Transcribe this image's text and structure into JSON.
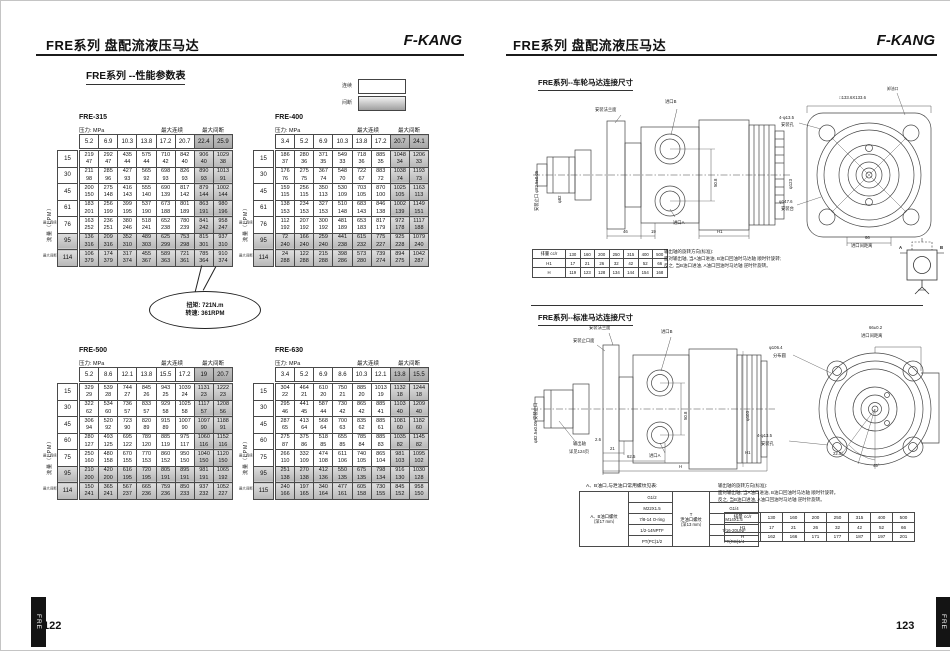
{
  "header": {
    "title": "FRE系列 盘配流液压马达",
    "brand": "F-KANG",
    "page_left": "122",
    "page_right": "123",
    "tab": "FRE"
  },
  "performance": {
    "section_title": "FRE系列 --性能参数表",
    "pressure_label": "压力: MPa",
    "flow_label": "流量（LPM）",
    "max_cont": "最大连续",
    "max_int": "最大间断",
    "legend": {
      "continuous": "连续",
      "intermittent": "间断"
    },
    "callout": {
      "line1": "扭矩: 721N.m",
      "line2": "转速: 361RPM"
    },
    "tables": [
      {
        "name": "FRE-315",
        "pressures": [
          "5.2",
          "6.9",
          "10.3",
          "13.8",
          "17.2",
          "20.7",
          "22.4",
          "25.9"
        ],
        "rows": [
          {
            "flow": "15",
            "torque": [
              219,
              292,
              435,
              575,
              710,
              842,
              906,
              1029
            ],
            "speed": [
              47,
              47,
              44,
              44,
              42,
              40,
              40,
              38
            ]
          },
          {
            "flow": "30",
            "torque": [
              211,
              285,
              427,
              565,
              698,
              826,
              890,
              1013
            ],
            "speed": [
              98,
              96,
              93,
              92,
              93,
              93,
              93,
              91
            ]
          },
          {
            "flow": "45",
            "torque": [
              200,
              275,
              416,
              555,
              690,
              817,
              879,
              1002
            ],
            "speed": [
              150,
              148,
              143,
              140,
              139,
              142,
              144,
              144
            ]
          },
          {
            "flow": "61",
            "torque": [
              183,
              256,
              399,
              537,
              673,
              801,
              863,
              980
            ],
            "speed": [
              201,
              199,
              195,
              190,
              188,
              189,
              191,
              196
            ]
          },
          {
            "flow": "76",
            "torque": [
              163,
              236,
              380,
              518,
              652,
              780,
              841,
              958
            ],
            "speed": [
              252,
              251,
              246,
              241,
              238,
              239,
              242,
              247
            ]
          },
          {
            "flow": "95",
            "torque": [
              136,
              209,
              352,
              489,
              625,
              753,
              815,
              937
            ],
            "speed": [
              316,
              316,
              310,
              303,
              299,
              298,
              301,
              310
            ]
          },
          {
            "flow": "114",
            "torque": [
              106,
              174,
              317,
              455,
              589,
              721,
              785,
              910
            ],
            "speed": [
              379,
              379,
              374,
              367,
              363,
              361,
              364,
              374
            ]
          }
        ]
      },
      {
        "name": "FRE-400",
        "pressures": [
          "3.4",
          "5.2",
          "6.9",
          "10.3",
          "13.8",
          "17.2",
          "20.7",
          "24.1"
        ],
        "rows": [
          {
            "flow": "15",
            "torque": [
              186,
              280,
              371,
              549,
              718,
              885,
              1048,
              1206
            ],
            "speed": [
              37,
              36,
              35,
              33,
              36,
              35,
              34,
              33
            ]
          },
          {
            "flow": "30",
            "torque": [
              176,
              275,
              367,
              548,
              722,
              883,
              1038,
              1193
            ],
            "speed": [
              76,
              75,
              74,
              70,
              67,
              72,
              74,
              73
            ]
          },
          {
            "flow": "45",
            "torque": [
              159,
              256,
              350,
              530,
              703,
              870,
              1025,
              1163
            ],
            "speed": [
              115,
              115,
              113,
              109,
              105,
              100,
              105,
              113
            ]
          },
          {
            "flow": "61",
            "torque": [
              138,
              234,
              327,
              510,
              683,
              846,
              1002,
              1149
            ],
            "speed": [
              153,
              153,
              153,
              148,
              143,
              138,
              139,
              151
            ]
          },
          {
            "flow": "76",
            "torque": [
              112,
              207,
              300,
              481,
              653,
              817,
              972,
              1117
            ],
            "speed": [
              192,
              192,
              192,
              189,
              183,
              179,
              178,
              188
            ]
          },
          {
            "flow": "95",
            "torque": [
              72,
              166,
              259,
              441,
              615,
              775,
              925,
              1079
            ],
            "speed": [
              240,
              240,
              240,
              238,
              232,
              227,
              228,
              240
            ]
          },
          {
            "flow": "114",
            "torque": [
              24,
              122,
              215,
              398,
              573,
              739,
              894,
              1042
            ],
            "speed": [
              288,
              288,
              288,
              286,
              280,
              274,
              275,
              287
            ]
          }
        ]
      },
      {
        "name": "FRE-500",
        "pressures": [
          "5.2",
          "8.6",
          "12.1",
          "13.8",
          "15.5",
          "17.2",
          "19",
          "20.7"
        ],
        "rows": [
          {
            "flow": "15",
            "torque": [
              329,
              539,
              744,
              845,
              943,
              1039,
              1131,
              1222
            ],
            "speed": [
              29,
              28,
              27,
              26,
              25,
              24,
              23,
              23
            ]
          },
          {
            "flow": "30",
            "torque": [
              322,
              534,
              736,
              833,
              929,
              1025,
              1117,
              1208
            ],
            "speed": [
              62,
              60,
              57,
              57,
              58,
              58,
              57,
              56
            ]
          },
          {
            "flow": "45",
            "torque": [
              306,
              520,
              723,
              820,
              915,
              1007,
              1097,
              1188
            ],
            "speed": [
              94,
              92,
              90,
              89,
              89,
              90,
              90,
              91
            ]
          },
          {
            "flow": "60",
            "torque": [
              280,
              493,
              695,
              789,
              885,
              975,
              1060,
              1152
            ],
            "speed": [
              127,
              125,
              122,
              120,
              119,
              117,
              116,
              116
            ]
          },
          {
            "flow": "75",
            "torque": [
              250,
              480,
              670,
              770,
              860,
              950,
              1040,
              1120
            ],
            "speed": [
              160,
              158,
              155,
              153,
              152,
              150,
              150,
              150
            ]
          },
          {
            "flow": "95",
            "torque": [
              210,
              420,
              616,
              720,
              805,
              895,
              981,
              1065
            ],
            "speed": [
              200,
              200,
              195,
              195,
              191,
              191,
              191,
              192
            ]
          },
          {
            "flow": "114",
            "torque": [
              150,
              365,
              567,
              665,
              759,
              850,
              937,
              1052
            ],
            "speed": [
              241,
              241,
              237,
              236,
              236,
              233,
              232,
              227
            ]
          }
        ]
      },
      {
        "name": "FRE-630",
        "pressures": [
          "3.4",
          "5.2",
          "6.9",
          "8.6",
          "10.3",
          "12.1",
          "13.8",
          "15.5"
        ],
        "rows": [
          {
            "flow": "15",
            "torque": [
              304,
              464,
              610,
              750,
              885,
              1013,
              1132,
              1244
            ],
            "speed": [
              22,
              21,
              20,
              21,
              20,
              19,
              18,
              18
            ]
          },
          {
            "flow": "30",
            "torque": [
              295,
              441,
              587,
              730,
              865,
              885,
              1103,
              1209
            ],
            "speed": [
              46,
              45,
              44,
              42,
              42,
              41,
              40,
              40
            ]
          },
          {
            "flow": "45",
            "torque": [
              287,
              413,
              568,
              700,
              835,
              885,
              1081,
              1182
            ],
            "speed": [
              65,
              64,
              64,
              63,
              62,
              61,
              60,
              60
            ]
          },
          {
            "flow": "60",
            "torque": [
              275,
              375,
              518,
              655,
              785,
              885,
              1035,
              1145
            ],
            "speed": [
              87,
              86,
              85,
              85,
              84,
              83,
              82,
              82
            ]
          },
          {
            "flow": "75",
            "torque": [
              266,
              332,
              474,
              611,
              740,
              865,
              981,
              1095
            ],
            "speed": [
              110,
              109,
              108,
              106,
              105,
              104,
              103,
              102
            ]
          },
          {
            "flow": "95",
            "torque": [
              251,
              270,
              412,
              550,
              675,
              798,
              916,
              1030
            ],
            "speed": [
              138,
              138,
              136,
              135,
              135,
              134,
              130,
              128
            ]
          },
          {
            "flow": "115",
            "torque": [
              240,
              197,
              340,
              477,
              605,
              730,
              845,
              958
            ],
            "speed": [
              166,
              165,
              164,
              161,
              158,
              155,
              152,
              150
            ]
          }
        ]
      }
    ]
  },
  "wheel": {
    "title": "FRE系列--车轮马达连接尺寸",
    "labels": {
      "flange_face": "安装法兰面",
      "port_b": "进口B",
      "port_a": "进口A",
      "pilot": "安装止口 φ82.5±0.05",
      "phi82": "φ82",
      "dim_50_8": "50.8",
      "phi123": "φ123",
      "dim_46": "46",
      "dim_19": "19",
      "dim_h1": "H1",
      "drain": "卸油口",
      "square": "□133.6X133.6",
      "holes": "4-φ13.5",
      "holes2": "安装孔",
      "boss": "φ147.6",
      "boss2": "安装台",
      "dim_66": "66",
      "spacing": "进口间距离"
    },
    "table": {
      "head": [
        "排量 cc/r",
        "130",
        "160",
        "200",
        "250",
        "315",
        "400",
        "500"
      ],
      "rows": [
        [
          "H1",
          "17",
          "21",
          "26",
          "32",
          "42",
          "52",
          "66"
        ],
        [
          "H",
          "119",
          "123",
          "128",
          "134",
          "144",
          "154",
          "168"
        ]
      ]
    },
    "note": [
      "输出轴的旋转方向(标准):",
      "面对输出轴, 当A油口进油, B油口回油时马达轴 顺时针旋转;",
      "反之, 当B油口进油, A油口回油时马达轴 逆时针旋转。"
    ],
    "symbol": {
      "a": "A",
      "b": "B"
    }
  },
  "standard": {
    "title": "FRE系列--标准马达连接尺寸",
    "labels": {
      "flange_face": "安装法兰面",
      "pilot_face": "安装止口面",
      "port_b": "进口B",
      "port_a": "进口A",
      "pilot": "φ82.5±0.05 安装止口",
      "shaft1": "输出轴",
      "shaft2": "详见124页",
      "dim_2_6": "2.6",
      "dim_21": "21",
      "dim_62_5": "62.5",
      "dim_h": "H",
      "dim_h1": "H1",
      "dim_50_8": "50.8",
      "phi103": "φ103",
      "spacing66": "66±0.2",
      "spacing": "进口间距离",
      "phi106": "φ106.4",
      "circle2": "分布圆",
      "holes": "4-φ13.5",
      "holes2": "安装孔",
      "angle225": "22.5°",
      "angle45": "45°"
    },
    "thread_caption": "A、B油口,与泄油口常用螺纹见表:",
    "thread_ab": {
      "label1": "A、B油口螺纹",
      "label2": "（深17 mm）",
      "values": [
        "G1/2",
        "M22X1.5",
        "7/8-14 O-ring",
        "1/2-14NPTF",
        "PT(PC)1/2"
      ]
    },
    "thread_t": {
      "label1": "T",
      "label2": "泄油口螺纹",
      "label3": "（深13 mm）",
      "values": [
        "",
        "G1/4",
        "M14X1.5",
        "7/16-20UNF",
        "PT(RC)1/4"
      ]
    },
    "note": [
      "输出轴的旋转方向(标准):",
      "面对输出轴, 当A油口进油, B油口回油时马达轴 顺时针旋转。",
      "反之, 当B油口进油, A油口回油时马达轴 逆时针旋转。"
    ],
    "table": {
      "head": [
        "排量 cc/r",
        "130",
        "160",
        "200",
        "250",
        "315",
        "400",
        "500"
      ],
      "rows": [
        [
          "H1",
          "17",
          "21",
          "26",
          "32",
          "42",
          "52",
          "66"
        ],
        [
          "H",
          "162",
          "166",
          "171",
          "177",
          "187",
          "197",
          "201"
        ]
      ]
    }
  }
}
